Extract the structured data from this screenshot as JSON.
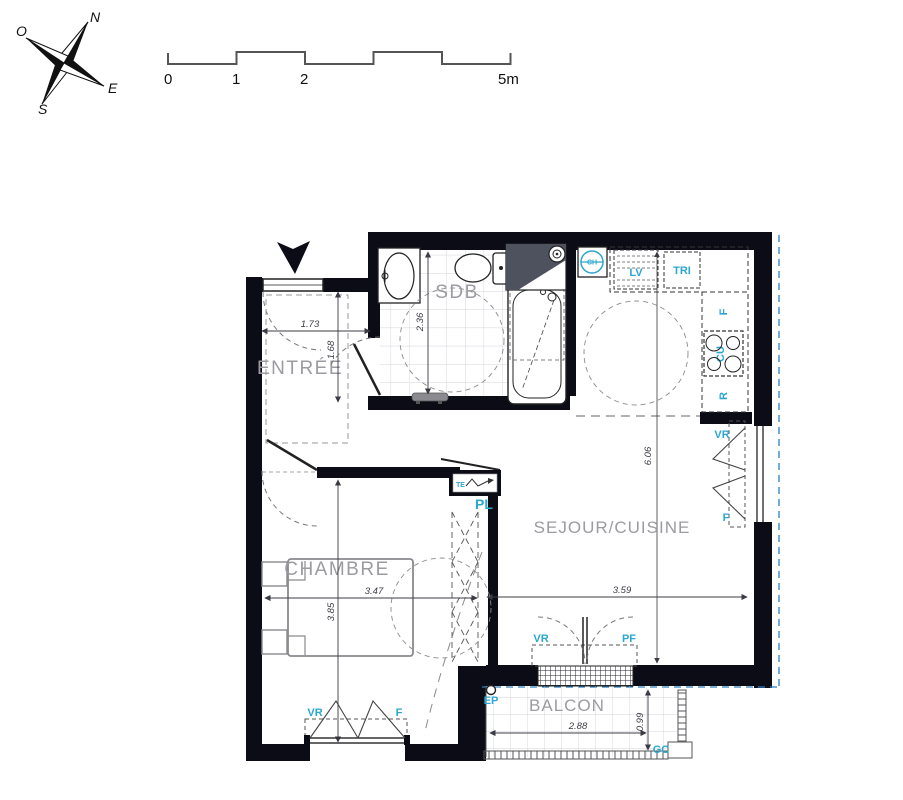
{
  "drawing": {
    "type": "apartment floor plan",
    "background": "#ffffff"
  },
  "compass": {
    "north": "N",
    "east": "E",
    "south": "S",
    "west": "O"
  },
  "scale_bar": {
    "tick0": "0",
    "tick1": "1",
    "tick2": "2",
    "tick5": "5m"
  },
  "rooms": {
    "entree": "ENTRÉE",
    "sdb": "SDB",
    "sejour": "SEJOUR/CUISINE",
    "chambre": "CHAMBRE",
    "balcon": "BALCON"
  },
  "dimensions": {
    "entree_width": "1.73",
    "entree_depth": "1.68",
    "sdb_depth": "2.36",
    "chambre_width": "3.47",
    "chambre_depth": "3.85",
    "sejour_width": "3.59",
    "sejour_depth": "6.06",
    "balcon_width": "2.88",
    "balcon_depth": "0.99"
  },
  "annotations": {
    "dishwasher": "LV",
    "recycling": "TRI",
    "water_heater": "CH",
    "fridge": "F",
    "cooktop": "CU",
    "range_storage": "R",
    "vr_kitchen_window": "VR",
    "f_kitchen_window": "F",
    "vr_balcony_door": "VR",
    "pf_balcony_door": "PF",
    "vr_chambre_window": "VR",
    "f_chambre_window": "F",
    "placard": "PL",
    "tableau_electrique": "TE",
    "rainwater_pipe": "EP",
    "guardrail": "GC"
  },
  "colors": {
    "wall": "#0c0c17",
    "annotation_cyan": "#2ba7cf",
    "room_label_gray": "#9b9ba1",
    "dimension_text": "#3b3b45",
    "boundary_blue": "#2e7fc1",
    "tile_line": "#c6c8ce"
  }
}
